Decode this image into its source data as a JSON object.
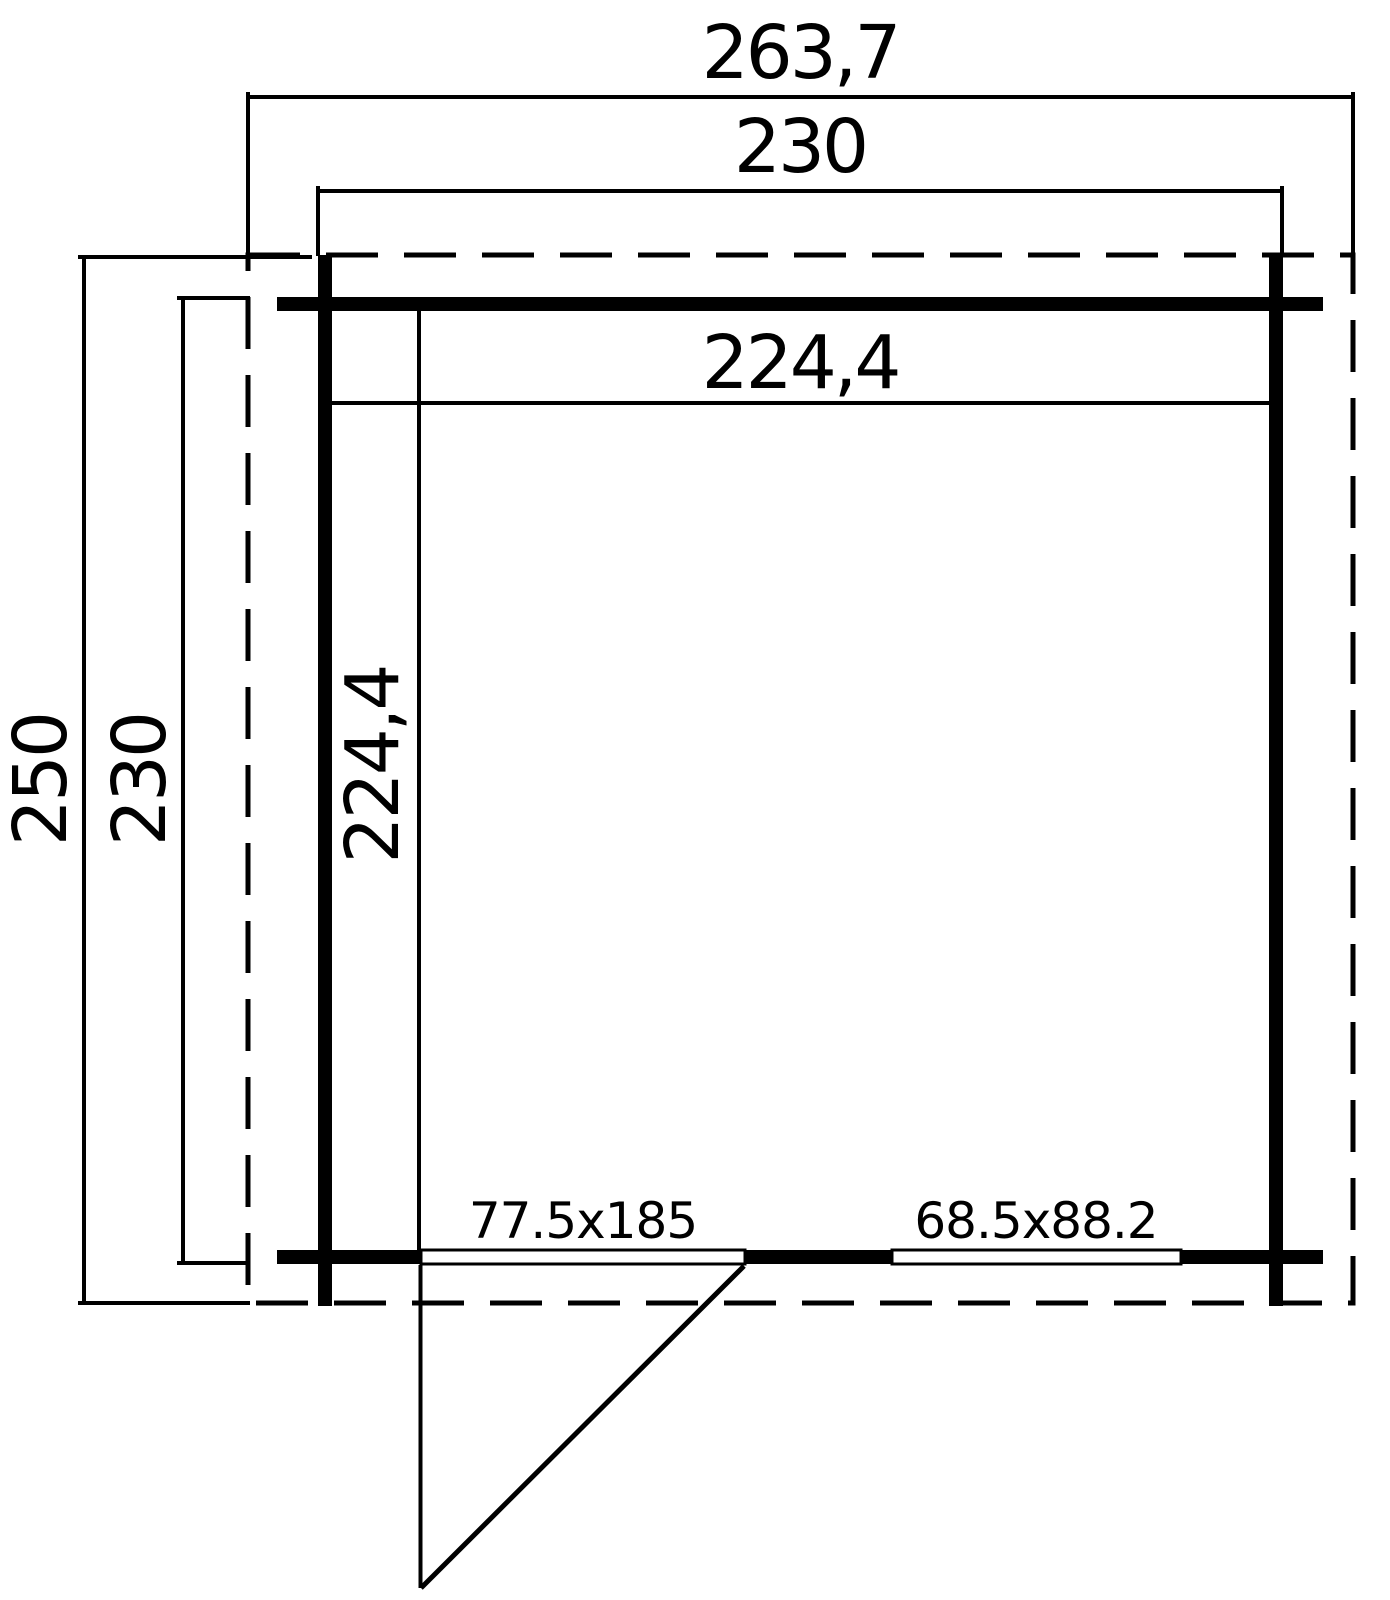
{
  "drawing": {
    "type": "floor-plan",
    "labels": {
      "roof_width": "263,7",
      "building_width": "230",
      "interior_width": "224,4",
      "roof_depth": "250",
      "building_depth": "230",
      "interior_depth": "224,4",
      "door_size": "77.5x185",
      "window_size": "68.5x88.2"
    },
    "colors": {
      "line": "#000000",
      "background": "#ffffff"
    }
  }
}
